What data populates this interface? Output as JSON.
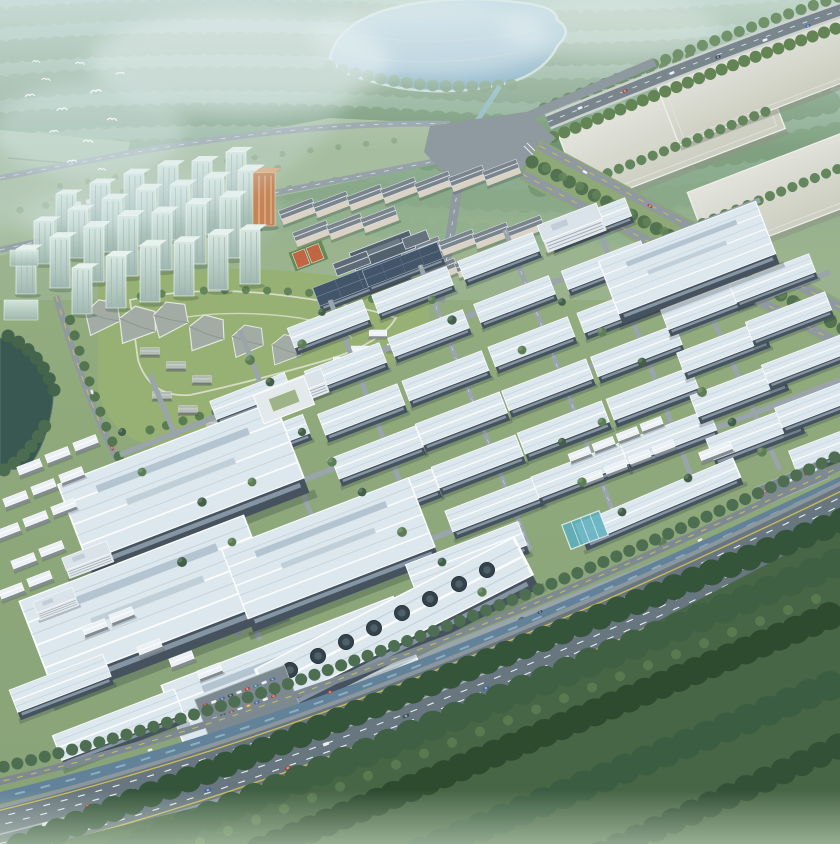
{
  "scene": {
    "description": "Aerial bird's-eye architectural rendering of a large industrial park: grid of white factory halls with pale blue roofs, residential tower cluster and apartment blocks at upper left, central campus with tennis courts and solar roofs, lake and forest at top, meadow ring road and interchange, three huge pale logistics halls at upper right, tree-lined boulevard, canal and a busy multi-lane highway crossing the lower right with dense dark forest beyond, flock of white birds over hazy woodland at top left",
    "regions": [
      "haze-sky",
      "top-forest",
      "lake",
      "stream",
      "meadow-loop",
      "interchange",
      "mega-halls",
      "top-highway",
      "boulevard",
      "residential-towers",
      "apartment-blocks",
      "campus",
      "tennis-courts",
      "park",
      "pond",
      "factory-grid",
      "big-factories",
      "fan-roof-building",
      "sheds",
      "parking-lots",
      "canal",
      "main-highway",
      "south-forest",
      "birds"
    ]
  },
  "palette": {
    "haze": "#d9e7ea",
    "skyTint": "#c3d8dc",
    "forestTop": "#7d9b76",
    "forestDark": "#33523a",
    "lake": "#84b0cd",
    "stream": "#86b4bc",
    "meadow": "#a3b792",
    "lawn": "#8fa770",
    "parkLawn": "#96ae6e",
    "road": "#8d969d",
    "asphalt": "#64717b",
    "laneYellow": "#c9b955",
    "canal": "#5d7e96",
    "roofLight": "#dfe8f0",
    "wallDark": "#414c58",
    "megaRoof": "#d8d7cd",
    "towerGlass": "#c5d6d0",
    "aptWall": "#ddd3c4",
    "aptRoof": "#778089",
    "solar": "#3e4f63",
    "campusRoof": "#4f5b68",
    "tennis": "#c2603c",
    "tennisRim": "#5e8850",
    "orangeTower": "#c8804f",
    "pond": "#33524a",
    "treeMid": "#587a4f",
    "treeDark": "#3c5a40",
    "treeSage": "#7c9a70",
    "treeBright": "#6f9158",
    "carRed": "#b5392f",
    "carBlue": "#3a5e9e",
    "carWhite": "#e9edf0",
    "carDark": "#30404e"
  }
}
